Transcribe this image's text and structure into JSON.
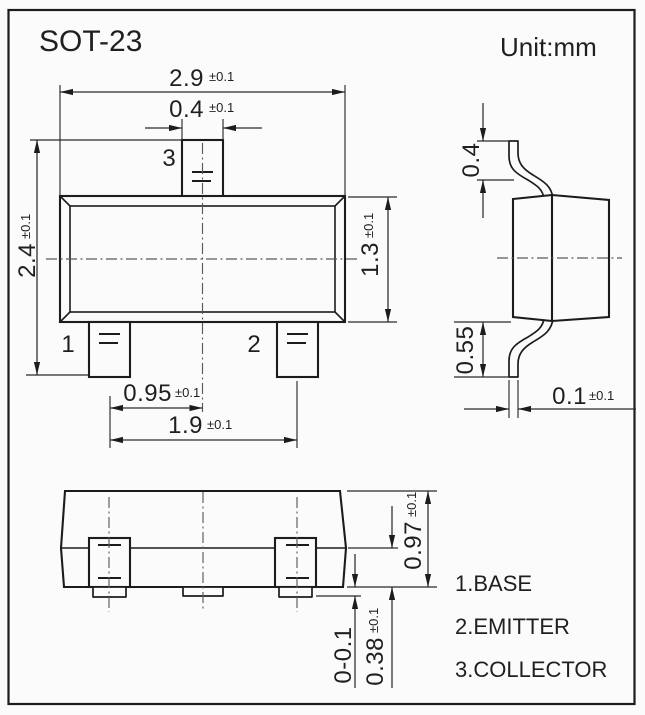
{
  "title": "SOT-23",
  "unit": "Unit:mm",
  "front_view": {
    "pin1_label": "1",
    "pin2_label": "2",
    "pin3_label": "3",
    "dim_body_width": {
      "value": "2.9",
      "tol": "±0.1"
    },
    "dim_lead_width": {
      "value": "0.4",
      "tol": "±0.1"
    },
    "dim_total_height": {
      "value": "2.4",
      "tol": "±0.1"
    },
    "dim_body_height": {
      "value": "1.3",
      "tol": "±0.1"
    },
    "dim_lead_offset": {
      "value": "0.95",
      "tol": "±0.1"
    },
    "dim_lead_pitch": {
      "value": "1.9",
      "tol": "±0.1"
    }
  },
  "side_view": {
    "dim_top_lead_height": "0.4",
    "dim_bottom_lead_height": "0.55",
    "dim_lead_thickness": {
      "value": "0.1",
      "tol": "±0.1"
    }
  },
  "bottom_view": {
    "dim_body_thickness": {
      "value": "0.97",
      "tol": "±0.1"
    },
    "dim_standoff": "0-0.1",
    "dim_foot_height": {
      "value": "0.38",
      "tol": "±0.1"
    }
  },
  "legend": {
    "items": [
      "1.BASE",
      "2.EMITTER",
      "3.COLLECTOR"
    ]
  }
}
